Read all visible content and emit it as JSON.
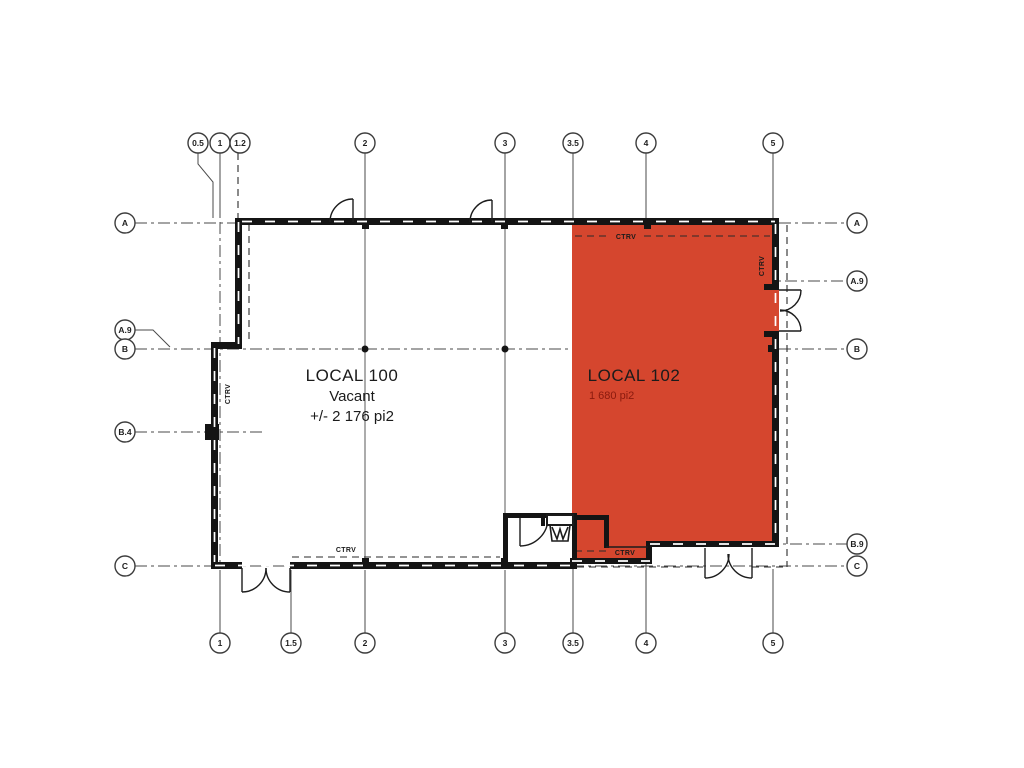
{
  "plan": {
    "units": {
      "local_100": {
        "name": "LOCAL 100",
        "status": "Vacant",
        "area": "+/- 2 176 pi2"
      },
      "local_102": {
        "name": "LOCAL 102",
        "area": "1 680 pi2"
      }
    },
    "wall_note": "CTRV",
    "highlight_color": "#d5462e",
    "grid": {
      "top": [
        "0.5",
        "1",
        "1.2",
        "2",
        "3",
        "3.5",
        "4",
        "5"
      ],
      "bottom": [
        "1",
        "1.5",
        "2",
        "3",
        "3.5",
        "4",
        "5"
      ],
      "left": [
        "A",
        "A.9",
        "B",
        "B.4",
        "C"
      ],
      "right": [
        "A",
        "A.9",
        "B",
        "B.9",
        "C"
      ]
    }
  }
}
